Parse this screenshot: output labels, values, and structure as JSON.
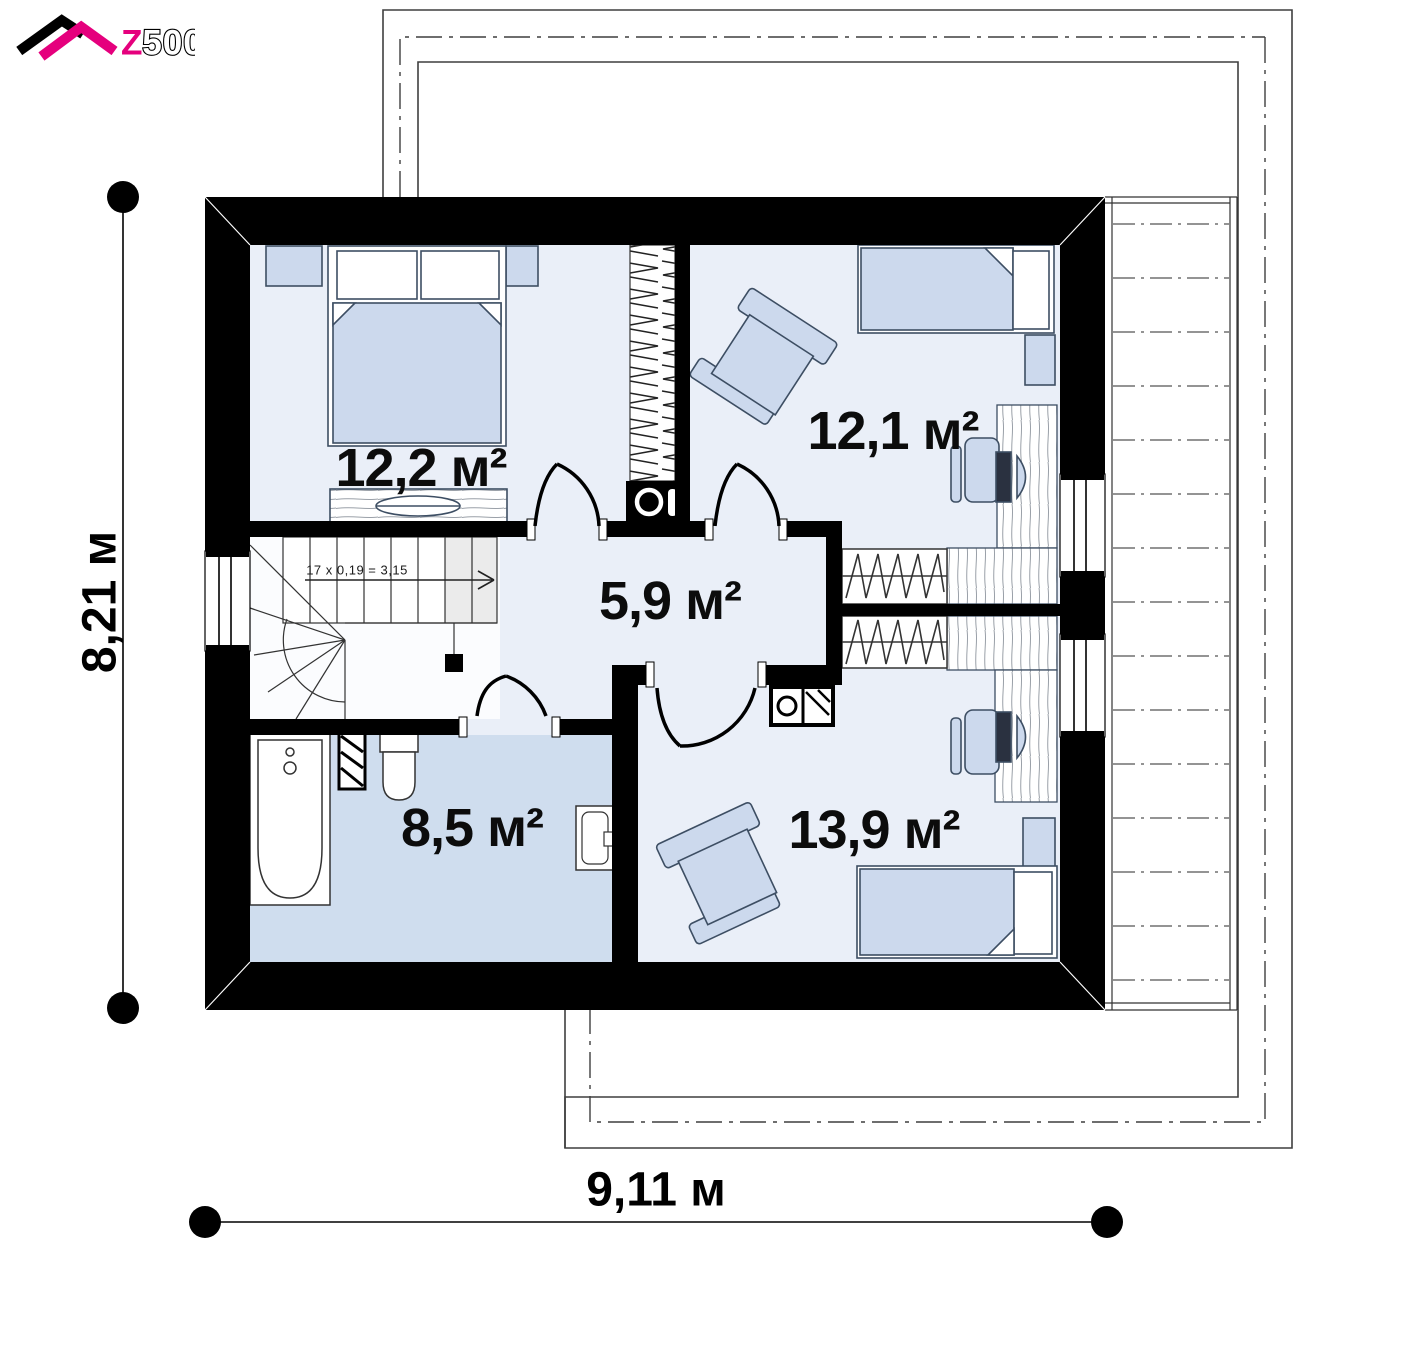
{
  "logo": {
    "z": "Z",
    "rest": "500"
  },
  "rooms": [
    {
      "id": "bedroom-top-left",
      "area": "12,2 м²"
    },
    {
      "id": "bedroom-top-right",
      "area": "12,1 м²"
    },
    {
      "id": "hall",
      "area": "5,9 м²"
    },
    {
      "id": "bathroom",
      "area": "8,5 м²"
    },
    {
      "id": "bedroom-bottom-right",
      "area": "13,9 м²"
    }
  ],
  "stairs": {
    "note": "17 x 0,19 = 3,15"
  },
  "dimensions": {
    "height_label": "8,21 м",
    "width_label": "9,11 м"
  },
  "colors": {
    "brand_magenta": "#e5007d",
    "wall_black": "#000000",
    "room_floor": "#eaeff8",
    "bathroom_floor": "#cfddee",
    "furniture_fill": "#ccd9ed",
    "outline_gray": "#3f3f3f"
  }
}
